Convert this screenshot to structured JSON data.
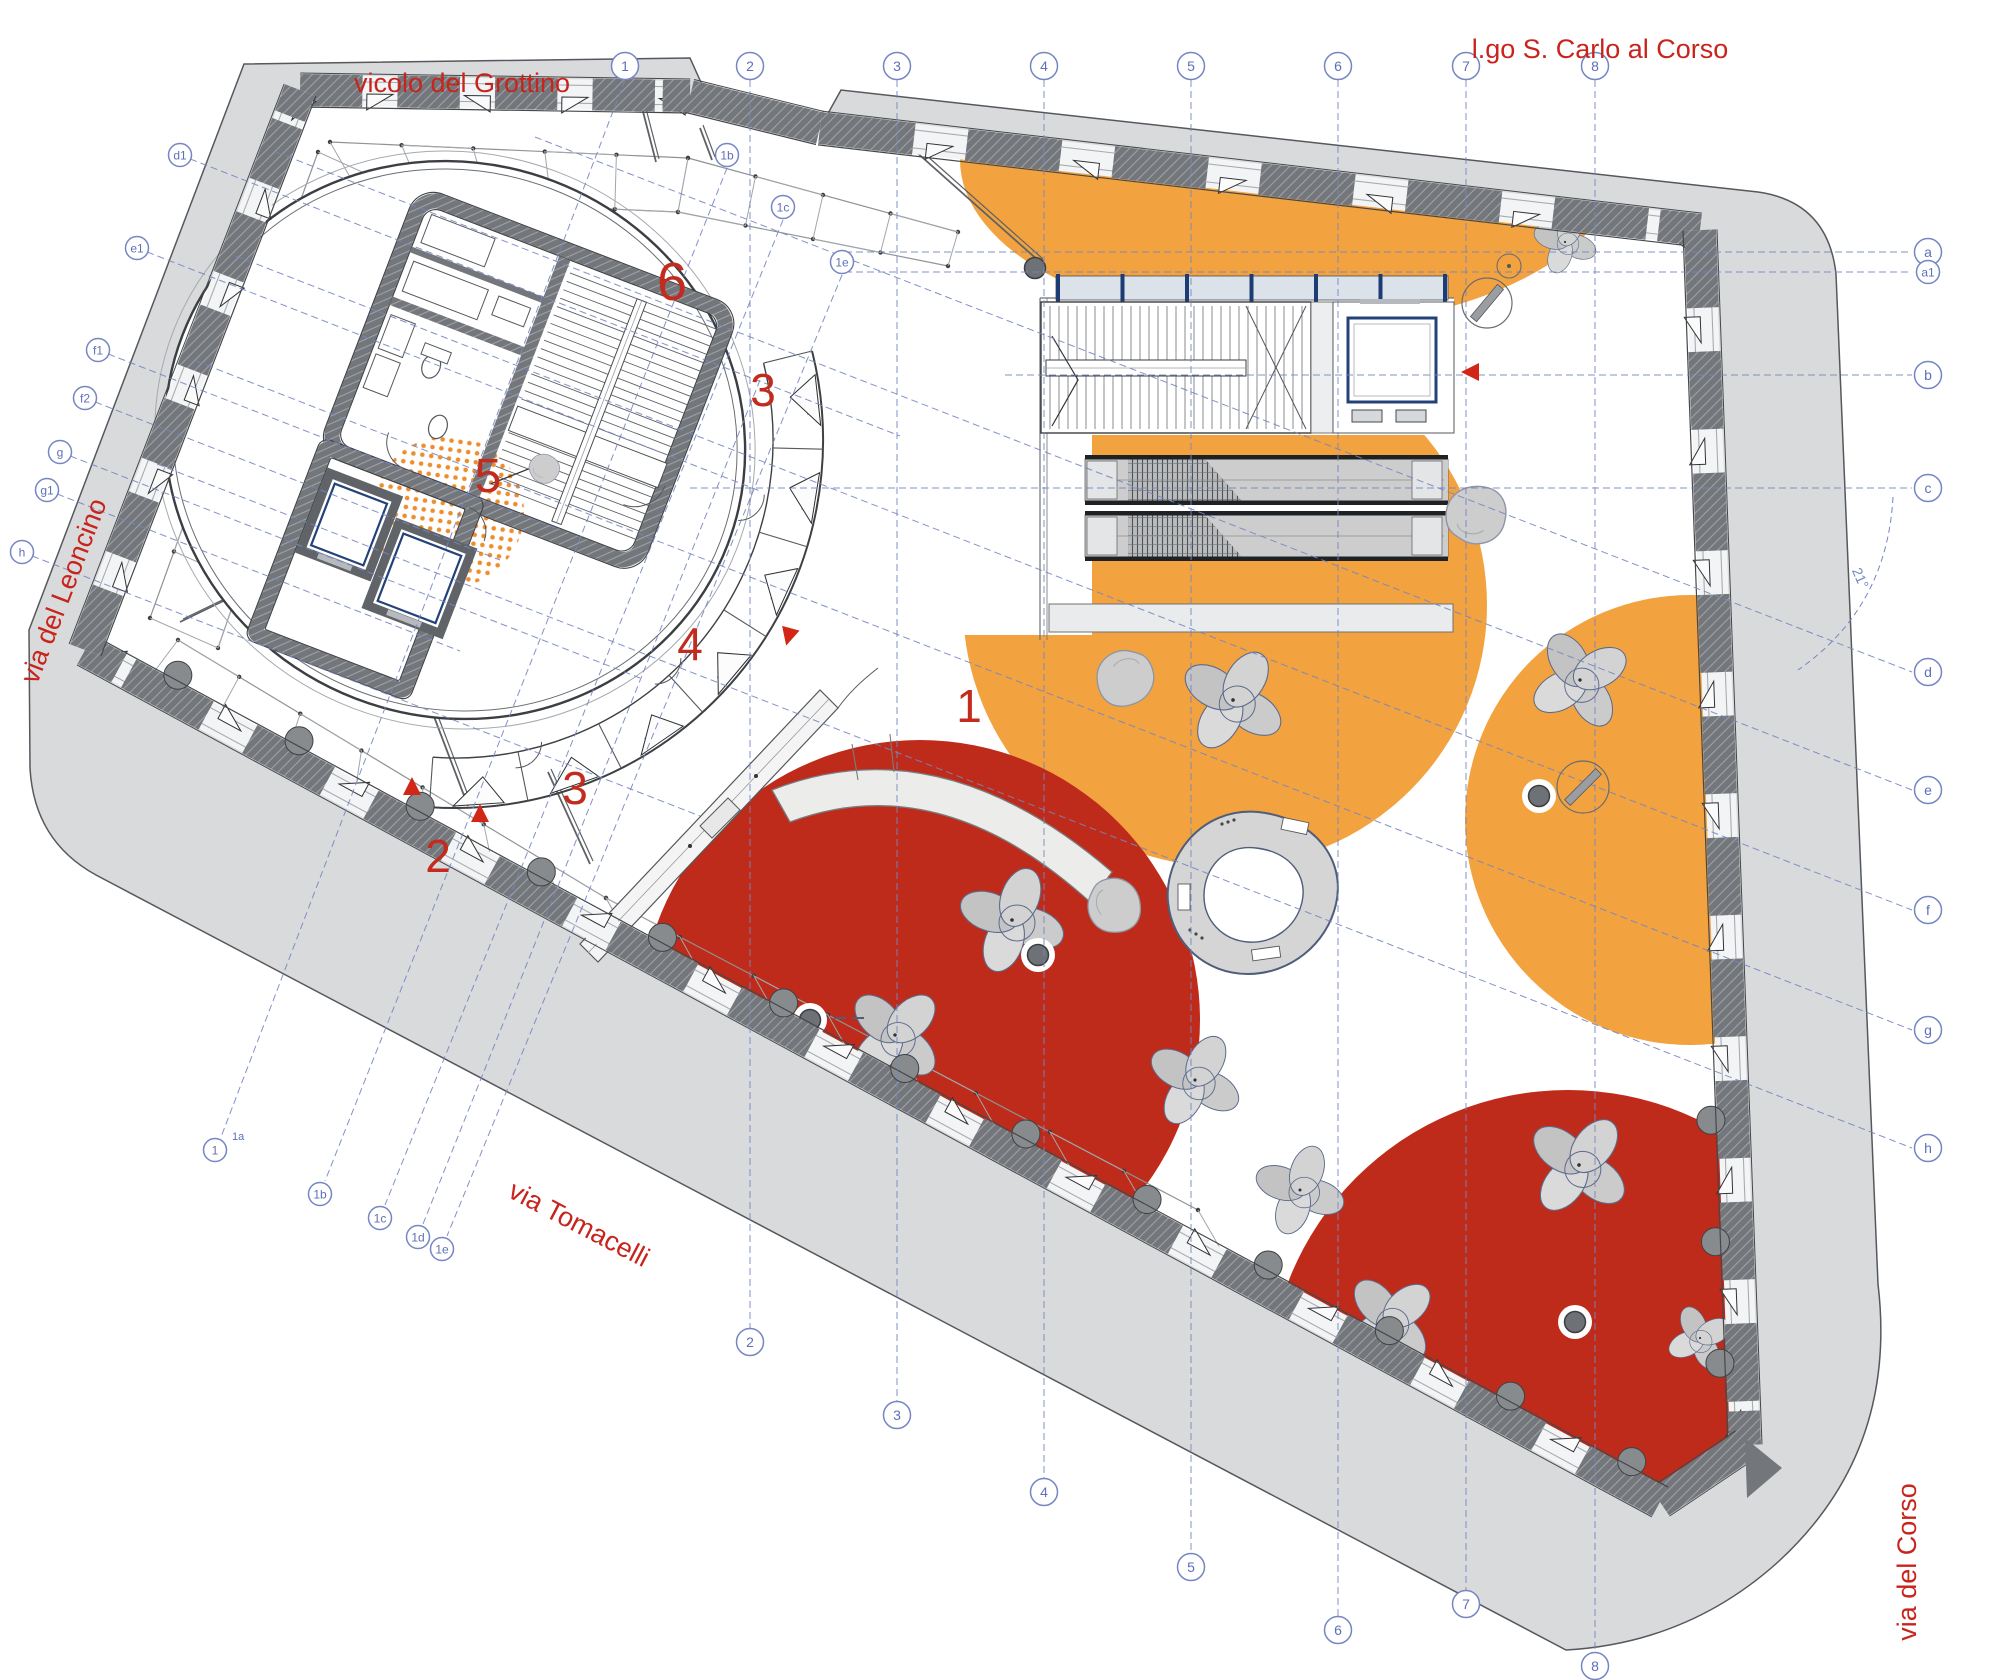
{
  "plan": {
    "streets": [
      {
        "id": "vicolo-del-grottino",
        "label": "vicolo del Grottino"
      },
      {
        "id": "lgo-s-carlo-al-corso",
        "label": "l.go S. Carlo al Corso"
      },
      {
        "id": "via-del-leoncino",
        "label": "via del Leoncino"
      },
      {
        "id": "via-tomacelli",
        "label": "via Tomacelli"
      },
      {
        "id": "via-del-corso",
        "label": "via del Corso"
      }
    ],
    "zones": [
      {
        "label": "1",
        "x": 969,
        "y": 722,
        "size": 46
      },
      {
        "label": "2",
        "x": 438,
        "y": 872,
        "size": 46
      },
      {
        "label": "3",
        "x": 763,
        "y": 406,
        "size": 46
      },
      {
        "label": "3",
        "x": 575,
        "y": 804,
        "size": 46
      },
      {
        "label": "4",
        "x": 690,
        "y": 660,
        "size": 46
      },
      {
        "label": "5",
        "x": 488,
        "y": 492,
        "size": 48
      },
      {
        "label": "6",
        "x": 672,
        "y": 300,
        "size": 54
      }
    ],
    "grid": {
      "top": [
        {
          "label": "1",
          "x": 625,
          "y": 66
        },
        {
          "label": "2",
          "x": 750,
          "y": 66
        },
        {
          "label": "3",
          "x": 897,
          "y": 66
        },
        {
          "label": "4",
          "x": 1044,
          "y": 66
        },
        {
          "label": "5",
          "x": 1191,
          "y": 66
        },
        {
          "label": "6",
          "x": 1338,
          "y": 66
        },
        {
          "label": "7",
          "x": 1466,
          "y": 66
        },
        {
          "label": "8",
          "x": 1595,
          "y": 66
        }
      ],
      "top_sub": [
        {
          "label": "1b",
          "x": 727,
          "y": 155
        },
        {
          "label": "1c",
          "x": 783,
          "y": 207
        },
        {
          "label": "1e",
          "x": 842,
          "y": 262
        }
      ],
      "bottom": [
        {
          "label": "2",
          "x": 750,
          "y": 1342
        },
        {
          "label": "3",
          "x": 897,
          "y": 1415
        },
        {
          "label": "4",
          "x": 1044,
          "y": 1492
        },
        {
          "label": "5",
          "x": 1191,
          "y": 1567
        },
        {
          "label": "6",
          "x": 1338,
          "y": 1630
        },
        {
          "label": "7",
          "x": 1466,
          "y": 1604
        },
        {
          "label": "8",
          "x": 1595,
          "y": 1666
        }
      ],
      "bottom_sub": [
        {
          "label": "1",
          "x": 215,
          "y": 1150,
          "sup": "1a"
        },
        {
          "label": "1b",
          "x": 320,
          "y": 1194
        },
        {
          "label": "1c",
          "x": 380,
          "y": 1218
        },
        {
          "label": "1d",
          "x": 418,
          "y": 1237
        },
        {
          "label": "1e",
          "x": 442,
          "y": 1249
        }
      ],
      "right": [
        {
          "label": "a",
          "x": 1928,
          "y": 252
        },
        {
          "label": "a1",
          "x": 1928,
          "y": 272
        },
        {
          "label": "b",
          "x": 1928,
          "y": 375
        },
        {
          "label": "c",
          "x": 1928,
          "y": 488
        },
        {
          "label": "d",
          "x": 1928,
          "y": 672
        },
        {
          "label": "e",
          "x": 1928,
          "y": 790
        },
        {
          "label": "f",
          "x": 1928,
          "y": 910
        },
        {
          "label": "g",
          "x": 1928,
          "y": 1030
        },
        {
          "label": "h",
          "x": 1928,
          "y": 1148
        }
      ],
      "left": [
        {
          "label": "d1",
          "x": 180,
          "y": 155
        },
        {
          "label": "e1",
          "x": 137,
          "y": 248
        },
        {
          "label": "f1",
          "x": 98,
          "y": 350
        },
        {
          "label": "f2",
          "x": 85,
          "y": 398
        },
        {
          "label": "g",
          "x": 60,
          "y": 452
        },
        {
          "label": "g1",
          "x": 47,
          "y": 490
        },
        {
          "label": "h",
          "x": 22,
          "y": 552
        }
      ]
    },
    "annotations": {
      "angle": "21°"
    },
    "colors": {
      "orange": "#F2A23F",
      "orange_dots": "#ED8E2D",
      "red": "#BE2B1A",
      "wall_dark": "#73767A",
      "sidewalk": "#D9DADC",
      "grid_blue": "#7586C2",
      "label_red": "#C8241C",
      "zone_red": "#C22B1E",
      "glass_blue": "#1D3C74",
      "door_chip_blue": "#5B79B4",
      "furniture_gray": "#C9C9C9"
    }
  }
}
